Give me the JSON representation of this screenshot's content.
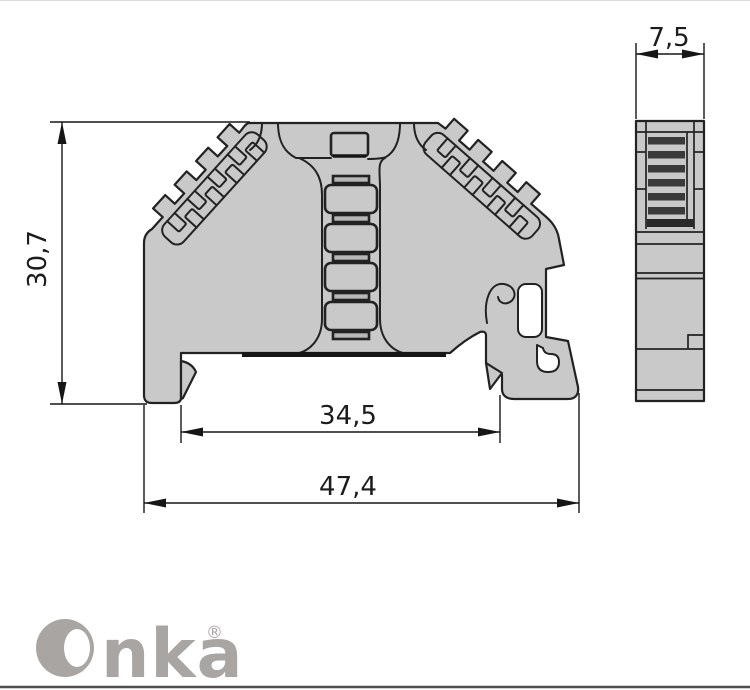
{
  "colors": {
    "background": "#ffffff",
    "body_fill": "#c9c9c9",
    "outline": "#222222",
    "dimension_line": "#161616",
    "stripe_dark": "#3a3a3a",
    "logo_gray": "#a8a5a2",
    "footer_line": "#4f4f4f"
  },
  "dimensions": {
    "height_label": "30,7",
    "rail_width_label": "34,5",
    "overall_width_label": "47,4",
    "thickness_label": "7,5"
  },
  "logo": {
    "text": "Onka",
    "tail": "nka",
    "registered_mark": "®"
  }
}
